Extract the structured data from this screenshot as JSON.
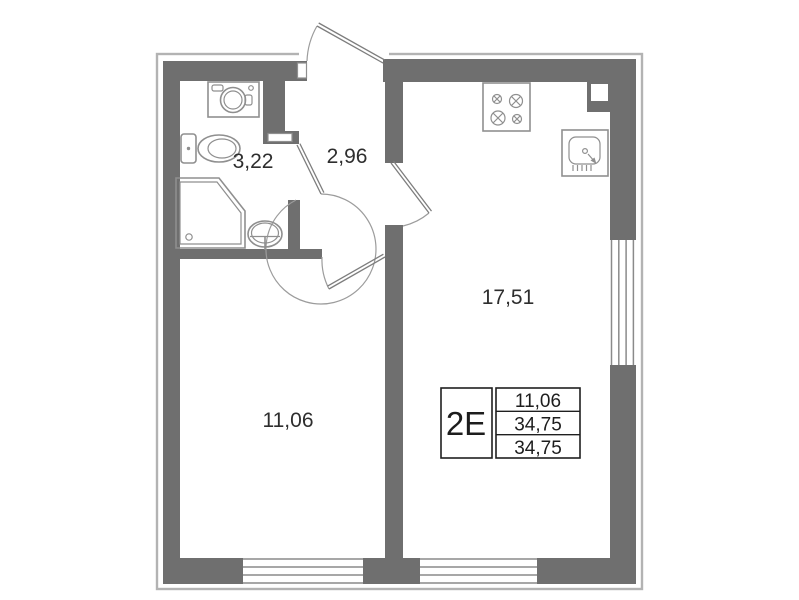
{
  "title": "apartment-floor-plan",
  "rooms": {
    "bathroom": {
      "area": "3,22"
    },
    "hallway": {
      "area": "2,96"
    },
    "bedroom": {
      "area": "11,06"
    },
    "kitchen_living": {
      "area": "17,51"
    }
  },
  "info_table": {
    "unit_type": "2Е",
    "values": [
      "11,06",
      "34,75",
      "34,75"
    ]
  },
  "fixtures": [
    "washing-machine",
    "toilet",
    "shower",
    "washbasin",
    "stove",
    "kitchen-sink",
    "vent-shaft"
  ],
  "colors": {
    "wall": "#6f6f6f",
    "contour": "#b3b3b3",
    "fixture_line": "#8f8f8f",
    "text": "#2e2e2e",
    "table_border": "#1f1f1f",
    "background": "#ffffff"
  }
}
